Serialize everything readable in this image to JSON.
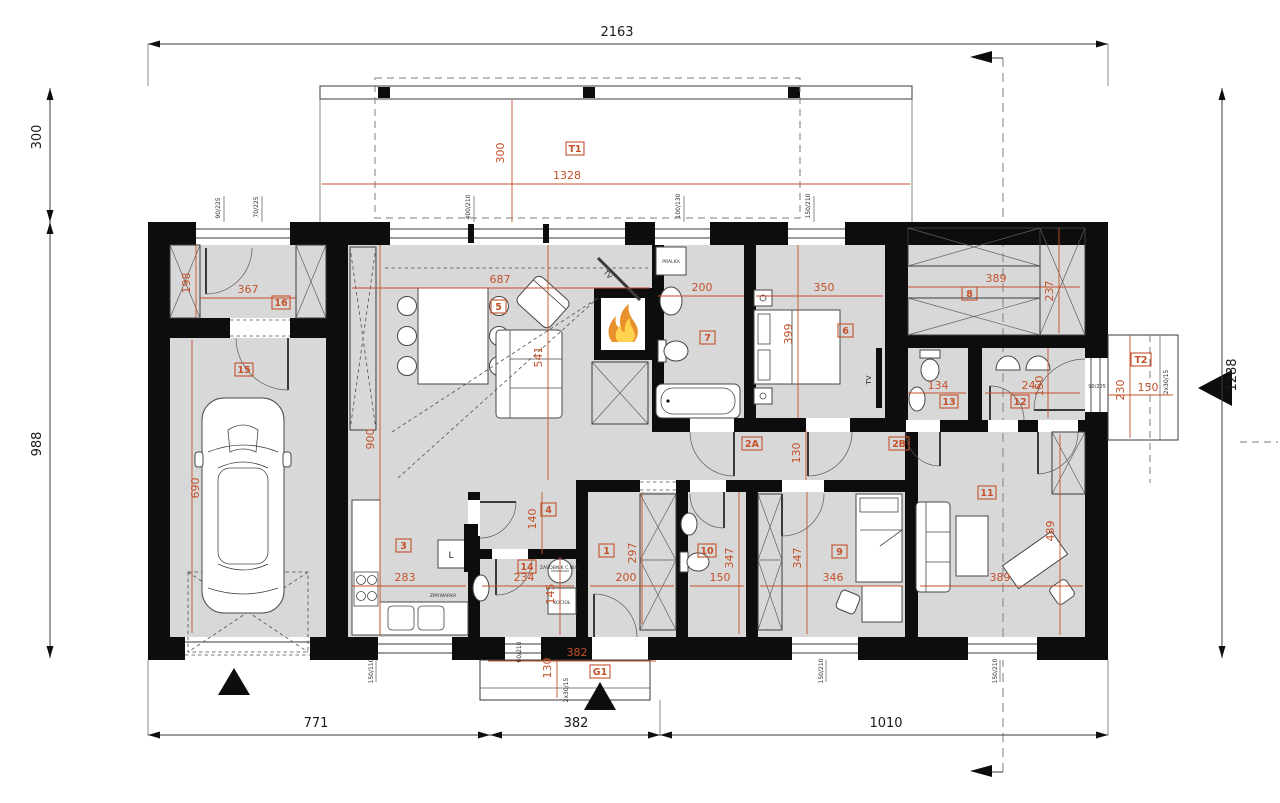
{
  "colors": {
    "dim_accent": "#c4512a",
    "wall": "#0d0d0d",
    "room_fill": "#d8d8d8",
    "flame_outer": "#e8902c",
    "flame_inner": "#ffd34d"
  },
  "overall": {
    "top": "2163",
    "bottom_left": "771",
    "bottom_mid": "382",
    "bottom_right": "1010",
    "left_top": "300",
    "left_main": "988",
    "right": "1288"
  },
  "terrace_t1": {
    "label": "T1",
    "depth": "300",
    "width": "1328"
  },
  "porch_g1": {
    "label": "G1",
    "width": "382",
    "depth": "130",
    "steps": "2x30/15"
  },
  "terrace_t2": {
    "label": "T2",
    "depth": "230",
    "width": "150",
    "steps": "2x30/15",
    "door": "90/205"
  },
  "rooms": {
    "r1": {
      "label": "1",
      "w": "200",
      "h": "297"
    },
    "r2a": {
      "label": "2A",
      "h": "130"
    },
    "r2b": {
      "label": "2B"
    },
    "r3": {
      "label": "3",
      "w": "283",
      "h": "900"
    },
    "r4": {
      "label": "4",
      "h": "140"
    },
    "r5": {
      "label": "5",
      "w": "687",
      "h": "541"
    },
    "r6": {
      "label": "6",
      "w": "350",
      "h": "399"
    },
    "r7": {
      "label": "7",
      "w": "200"
    },
    "r8": {
      "label": "8",
      "w": "389",
      "h": "237"
    },
    "r9": {
      "label": "9",
      "w": "346",
      "h": "347"
    },
    "r10": {
      "label": "10",
      "w": "150",
      "h": "347"
    },
    "r11": {
      "label": "11",
      "w": "389",
      "h": "489"
    },
    "r12": {
      "label": "12",
      "w": "242",
      "h": "150"
    },
    "r13": {
      "label": "13",
      "w": "134"
    },
    "r14": {
      "label": "14",
      "w": "234",
      "h": "145"
    },
    "r15": {
      "label": "15",
      "h": "690"
    },
    "r16": {
      "label": "16",
      "w": "367",
      "h": "198"
    }
  },
  "fixtures": {
    "washer": "PRALKA",
    "dishwasher": "ZMYWARKA",
    "boiler": "KOCIOŁ",
    "tank": "ZASOBNIK C.W.U.",
    "fridge": "L",
    "tv": "TV"
  },
  "openings": {
    "garage_win_a": "90/225",
    "garage_win_b": "70/225",
    "living_win": "400/210",
    "bath7_win": "100/130",
    "bed6_win": "150/210",
    "kitchen_win": "150/110",
    "util_win": "60/210",
    "bed9_win": "150/210",
    "room11_win": "150/210"
  }
}
